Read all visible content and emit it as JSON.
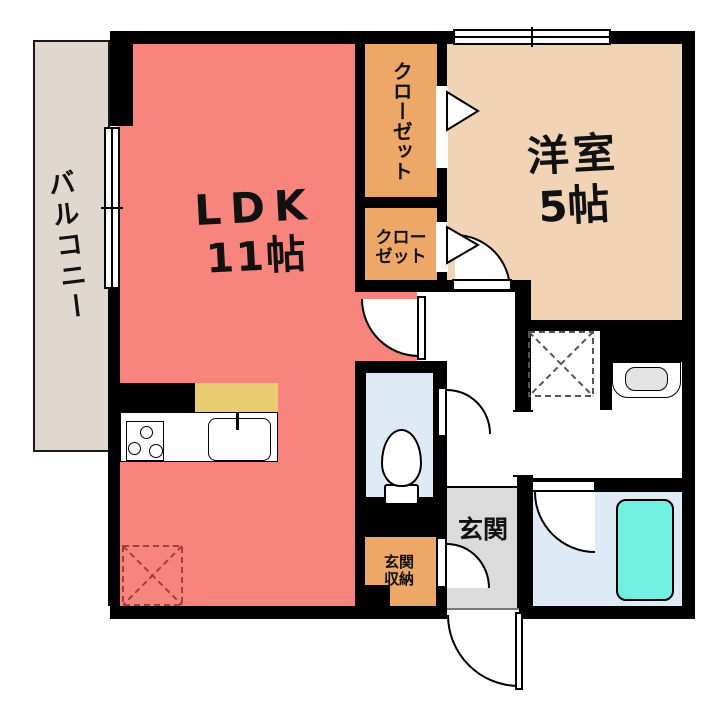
{
  "plan": {
    "rooms": {
      "balcony": {
        "label": "バルコニー",
        "color": "#E0D8CF"
      },
      "ldk": {
        "name": "LDK",
        "size": "11帖",
        "color": "#F7857E"
      },
      "western_room": {
        "name": "洋室",
        "size": "5帖",
        "color": "#F1D3B5"
      },
      "closet_upper": {
        "label": "クローゼット",
        "color": "#EDA766"
      },
      "closet_lower": {
        "label": "クロー\nゼット",
        "color": "#EDA766"
      },
      "entrance": {
        "label": "玄関",
        "color": "#DBDBDB"
      },
      "entrance_storage": {
        "label": "玄関\n収納",
        "color": "#EDA766"
      },
      "toilet": {
        "color": "#DEEAF6"
      },
      "washroom": {
        "color": "#FFFFFF"
      },
      "bathroom": {
        "color": "#DEEAF6"
      }
    },
    "fixtures": {
      "bathtub_color": "#72F1E3",
      "kitchen_counter_top_color": "#E9CC72",
      "basin_bowl_color": "#E4E4E4",
      "refrigerator_dash_color": "#A04038",
      "washer_dash_color": "#555555"
    },
    "wall_color": "#000000"
  }
}
